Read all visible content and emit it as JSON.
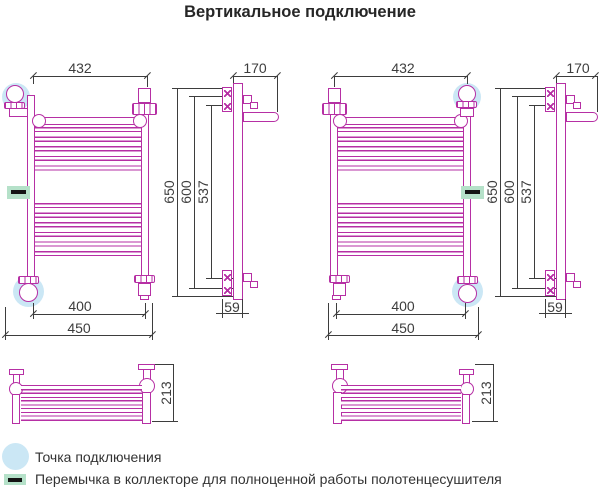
{
  "title": "Вертикальное подключение",
  "colors": {
    "outline": "#b62fa4",
    "dimension": "#3d3d3d",
    "connection_highlight": "#cbe7f5",
    "jumper_highlight": "#b5e1c9",
    "jumper_dash": "#141414"
  },
  "diagrams": {
    "left": {
      "top_width": "432",
      "depth": "170",
      "height_outer": "650",
      "height_mid": "600",
      "height_inner": "537",
      "bottom_width_inner": "400",
      "bottom_width_outer": "450",
      "wall_offset": "59",
      "shelf_depth": "213"
    },
    "right": {
      "top_width": "432",
      "depth": "170",
      "height_outer": "650",
      "height_mid": "600",
      "height_inner": "537",
      "bottom_width_inner": "400",
      "bottom_width_outer": "450",
      "wall_offset": "59",
      "shelf_depth": "213"
    }
  },
  "legend": {
    "connection_point": "Точка подключения",
    "jumper": "Перемычка в коллекторе для полноценной работы полотенцесушителя"
  }
}
